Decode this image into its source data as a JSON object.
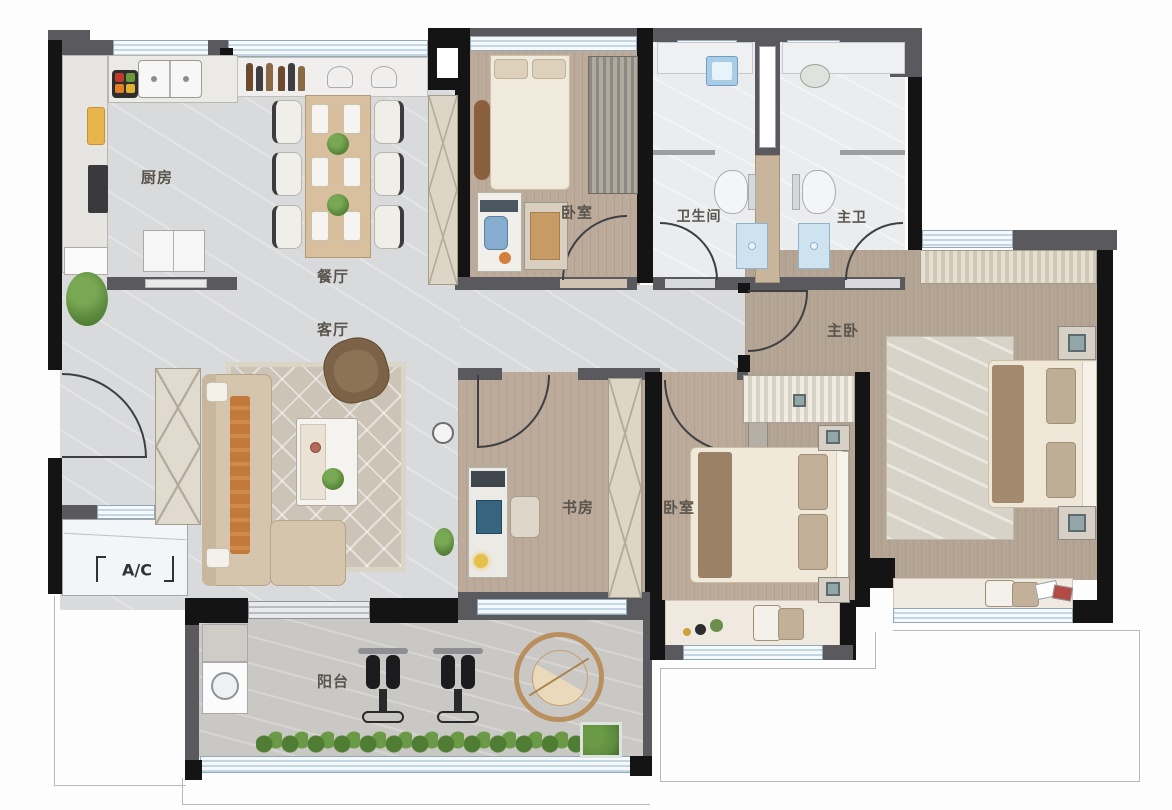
{
  "plan": {
    "rooms": {
      "kitchen": {
        "label": "厨房"
      },
      "dining": {
        "label": "餐厅"
      },
      "living": {
        "label": "客厅"
      },
      "bedroom_top": {
        "label": "卧室"
      },
      "bathroom": {
        "label": "卫生间"
      },
      "master_bathroom": {
        "label": "主卫"
      },
      "master_bedroom": {
        "label": "主卧"
      },
      "study": {
        "label": "书房"
      },
      "bedroom_second": {
        "label": "卧室"
      },
      "balcony": {
        "label": "阳台"
      },
      "ac_platform": {
        "label": "A/C"
      }
    },
    "colors": {
      "wall_black": "#141414",
      "wall_gray": "#5a5a5e",
      "window_blue": "#c2d6e3",
      "floor_marble": "#d9dadc",
      "floor_wood": "#bcab9a",
      "floor_bath": "#eaecee",
      "floor_balcony": "#cac8c5",
      "plant_green": "#5d8c3e",
      "accent_orange": "#c3793a"
    }
  }
}
